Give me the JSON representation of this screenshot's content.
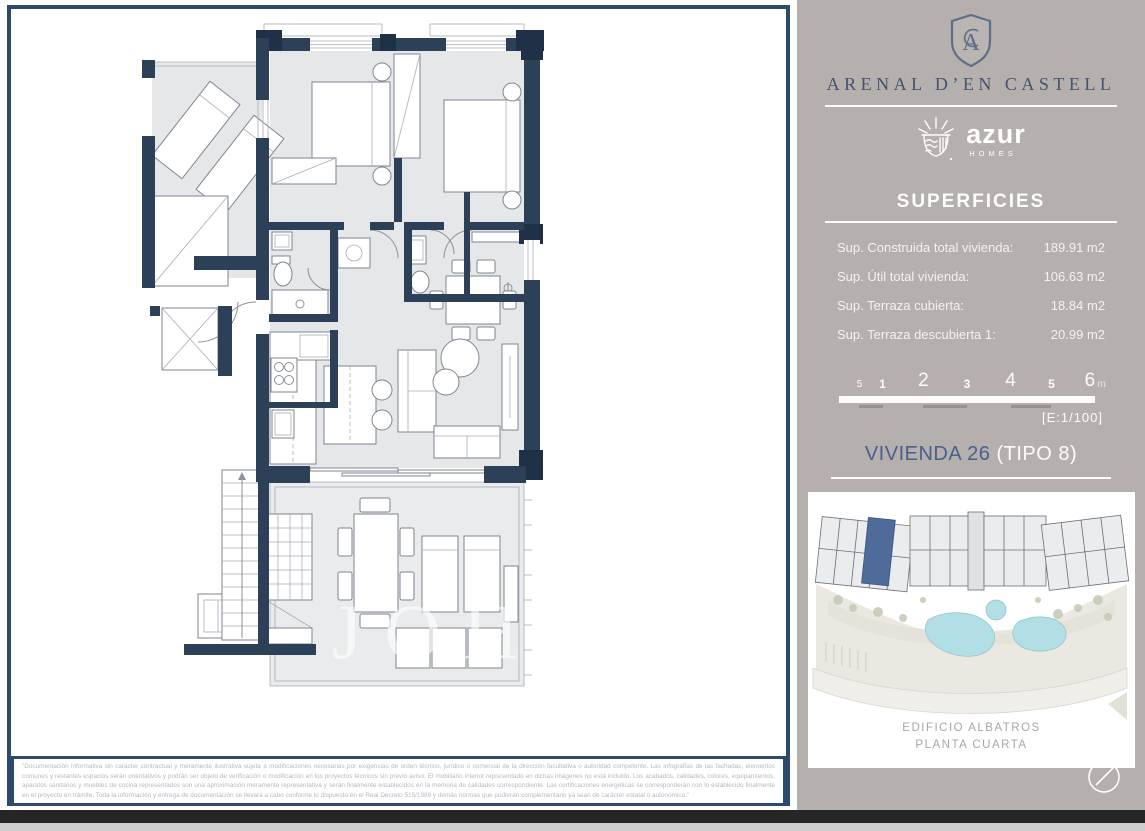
{
  "sidebar": {
    "project_title": "ARENAL D’EN CASTELL",
    "brand": {
      "name": "azur",
      "tagline": "HOMES"
    },
    "superficies": {
      "title": "SUPERFICIES",
      "rows": [
        {
          "label": "Sup. Construida total vivienda:",
          "value": "189.91 m2"
        },
        {
          "label": "Sup. Útil total vivienda:",
          "value": "106.63 m2"
        },
        {
          "label": "Sup. Terraza cubierta:",
          "value": "18.84 m2"
        },
        {
          "label": "Sup. Terraza descubierta 1:",
          "value": "20.99 m2"
        }
      ]
    },
    "scale_bar": {
      "ticks": [
        "5",
        "1",
        "2",
        "3",
        "4",
        "5",
        "6"
      ],
      "unit": "m",
      "scale_note": "[E:1/100]"
    },
    "unit_title": {
      "name": "VIVIENDA 26",
      "type": "(TIPO 8)"
    },
    "siteplan_caption_line1": "EDIFICIO ALBATROS",
    "siteplan_caption_line2": "PLANTA CUARTA"
  },
  "plan": {
    "watermark": "JOH"
  },
  "disclaimer": "\"Documentación informativa sin carácter contractual y meramente ilustrativa sujeta a modificaciones necesarias por exigencias de orden técnico, jurídico o comercial de la dirección facultativa o autoridad competente. Las infografías de las fachadas, elementos comunes y restantes espacios serán orientativos y podrán ser objeto de verificación o modificación en los proyectos técnicos sin previo aviso. El mobiliario interior representado en dichas imágenes no está incluido. Los acabados, calidades, colores, equipamientos, aparatos sanitarios y muebles de cocina representados son una aproximación meramente representativa y serán finalmente establecidos en la memoria de calidades correspondiente. Las certificaciones energéticas se corresponderán con lo establecido finalmente en el proyecto en trámite. Toda la información y entrega de documentación se llevará a cabo conforme lo dispuesto en el Real Decreto 515/1989 y demás normas que pudieran complementarlo ya sean de carácter estatal o autonómico.\"",
  "colors": {
    "wall_navy": "#2c4158",
    "frame_blue": "#2c4a6b",
    "sidebar_taupe": "#b5afae",
    "accent_blue": "#47618c",
    "highlight_unit": "#4f6b9a",
    "pool_cyan": "#b2dfe6",
    "bar_black": "#262626"
  }
}
